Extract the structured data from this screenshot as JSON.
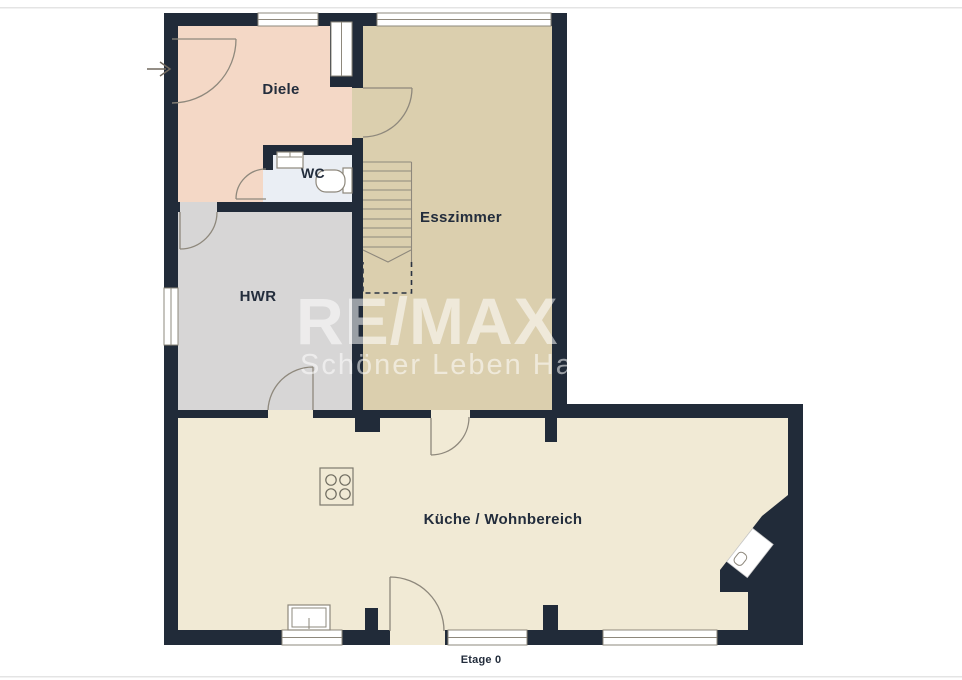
{
  "floorplan": {
    "title": "Etage 0",
    "rooms": [
      {
        "id": "diele",
        "label": "Diele"
      },
      {
        "id": "wc",
        "label": "WC"
      },
      {
        "id": "esszimmer",
        "label": "Esszimmer"
      },
      {
        "id": "hwr",
        "label": "HWR"
      },
      {
        "id": "kueche",
        "label": "Küche / Wohnbereich"
      }
    ],
    "watermark": {
      "line1": "RE/MAX",
      "line2": "Schöner Leben Ham"
    },
    "icons": {
      "entrance": "arrow-right-icon"
    },
    "colors": {
      "wall": "#212b39",
      "diele": "#f4d8c6",
      "esszimmer": "#dbcfae",
      "hwr": "#d7d6d6",
      "wc": "#eaeef4",
      "kueche": "#f1ead5",
      "window": "#ffffff",
      "line": "#8e887c",
      "dash": "#2a3342",
      "text": "#232d3c"
    }
  }
}
